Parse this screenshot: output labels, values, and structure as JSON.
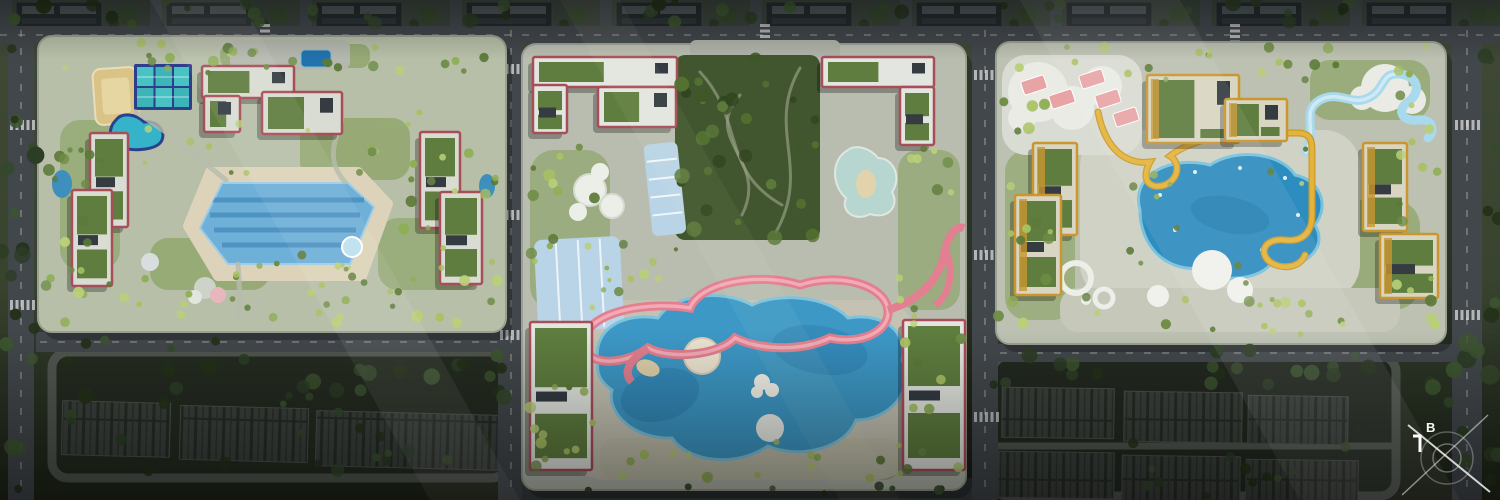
{
  "compass": {
    "label": "B"
  },
  "palette": {
    "field_green": "#46503a",
    "field_dark": "#242b20",
    "road_gray": "#42474b",
    "road_dark": "#3a3f42",
    "sidewalk": "#9aa092",
    "parcel_base_west": "#b7bfa8",
    "parcel_base_central": "#b9bdb0",
    "parcel_base_east": "#bcc1b1",
    "deck_beige": "#ddd3ba",
    "plaza_gray": "#c7c3b4",
    "park_green": "#41562e",
    "lagoon_blue": "#3d98c6",
    "lagoon_rim": "#7ec3de",
    "lap_pool_blue": "#6fb0d8",
    "lap_lane_blue": "#4a8fc0",
    "east_pool_blue": "#2e8dbf",
    "court_teal": "#49c2c4",
    "court_navy": "#2c3e8c",
    "sand_court": "#d9c387",
    "track_pink": "#e27f90",
    "track_pink_light": "#f3aab6",
    "slide_yellow": "#e4b33c",
    "lazy_river_blue": "#a8d9ec",
    "canopy_blue": "#b9d4e6",
    "court_pink": "#e8a4a4",
    "trim_maroon": "#a84e58",
    "trim_orange": "#c9962f",
    "roof_white": "#e3e6e0",
    "roof_green": "#5f7d3f",
    "panel_dark": "#343c42",
    "townhouse_dark": "#3b413c",
    "splash_pale": "#b8d6d0",
    "compass_white": "#f5f6f4"
  },
  "foliage": {
    "dark": [
      "#2c3d25",
      "#35492c",
      "#243119",
      "#3d5530"
    ],
    "light": [
      "#a9c162",
      "#8fae56",
      "#6f8c46",
      "#b9cf78",
      "#5c7a38"
    ],
    "park": [
      "#31451f",
      "#3e5628",
      "#54722f",
      "#5d7a3b"
    ]
  },
  "parcels": [
    {
      "name": "west-residential-block",
      "amenities": [
        "multi-sport-court-cluster",
        "sand-court",
        "kidney-pool",
        "main-lap-pool",
        "jacuzzi",
        "playgrounds",
        "green-roof-buildings"
      ]
    },
    {
      "name": "central-resort-block",
      "amenities": [
        "forest-park",
        "pink-elevated-loop-track",
        "lagoon-pool",
        "splash-pad",
        "shade-canopies",
        "green-roof-buildings"
      ]
    },
    {
      "name": "east-resort-block",
      "amenities": [
        "pink-paddle-courts",
        "shade-canopies",
        "lagoon-pool",
        "yellow-water-slide",
        "lazy-river",
        "dome-canopies",
        "green-roof-buildings"
      ]
    }
  ],
  "surroundings": [
    "villa-rows-north",
    "townhouse-rows-southwest",
    "townhouse-rows-southeast",
    "perimeter-road-grid",
    "tree-buffer"
  ]
}
